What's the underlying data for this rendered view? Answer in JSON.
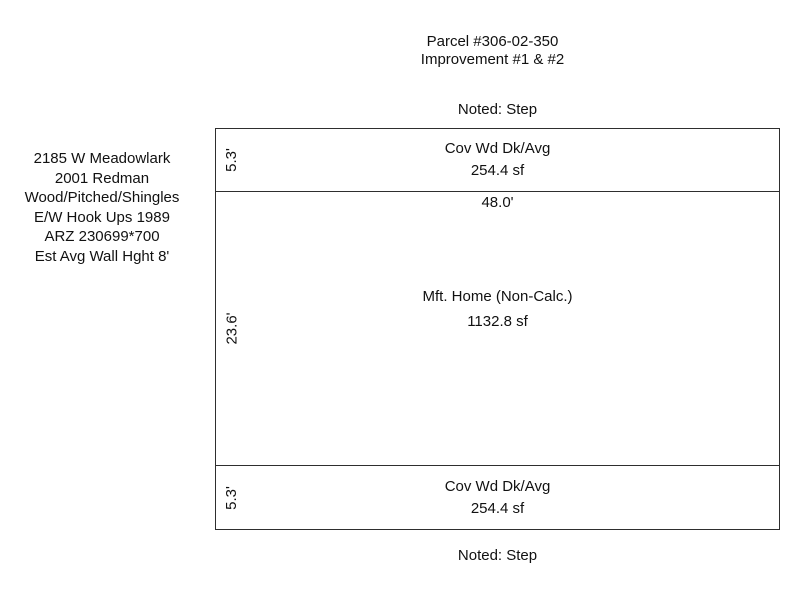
{
  "page": {
    "title_line1": "Parcel #306-02-350",
    "title_line2": "Improvement #1 & #2"
  },
  "notes": {
    "top": "Noted: Step",
    "bottom": "Noted: Step"
  },
  "info_block": {
    "lines": [
      "2185 W Meadowlark",
      "2001 Redman",
      "Wood/Pitched/Shingles",
      "E/W Hook Ups 1989",
      "ARZ 230699*700",
      "Est Avg Wall Hght 8'"
    ]
  },
  "sketch": {
    "sections": {
      "top_deck": {
        "label": "Cov Wd Dk/Avg",
        "area": "254.4 sf",
        "depth_dim": "5.3'"
      },
      "main": {
        "label": "Mft. Home (Non-Calc.)",
        "area": "1132.8 sf",
        "depth_dim": "23.6'",
        "width_dim": "48.0'"
      },
      "bottom_deck": {
        "label": "Cov Wd Dk/Avg",
        "area": "254.4 sf",
        "depth_dim": "5.3'"
      }
    },
    "colors": {
      "line": "#2e2e2e",
      "text": "#111111",
      "background": "#ffffff"
    }
  }
}
